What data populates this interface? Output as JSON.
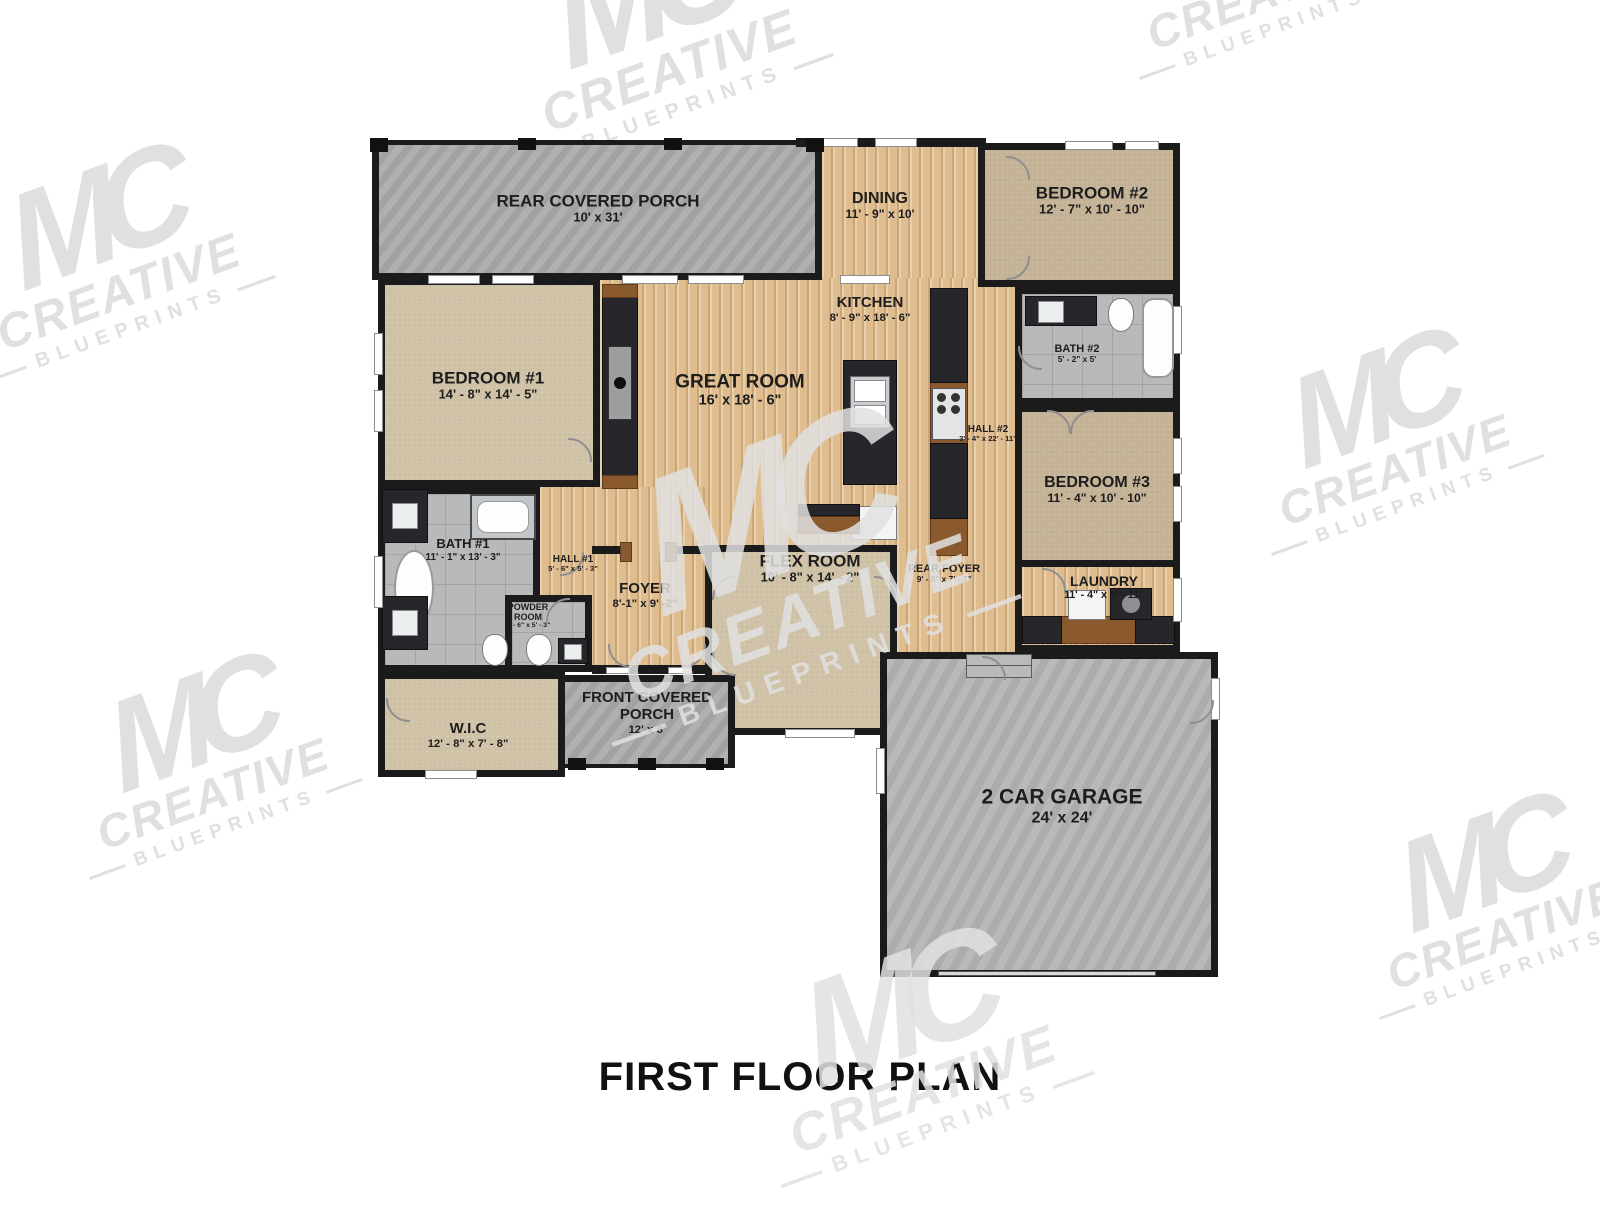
{
  "title": "FIRST FLOOR PLAN",
  "watermark": {
    "mc": "MC",
    "creative": "CREATIVE",
    "blueprints": "BLUEPRINTS"
  },
  "colors": {
    "wall": "#1b1b1b",
    "wood_floor": "#dfbd8f",
    "carpet": "#cdbfa4",
    "tile": "#b7b9bb",
    "concrete": "#aaacad",
    "accent_wood": "#8a5a2e",
    "watermark_gray": "#e0e0e0"
  },
  "rooms": {
    "rear_porch": {
      "name": "REAR COVERED PORCH",
      "dims": "10' x 31'"
    },
    "dining": {
      "name": "DINING",
      "dims": "11' - 9\" x 10'"
    },
    "bedroom2": {
      "name": "BEDROOM #2",
      "dims": "12' - 7\" x 10' - 10\""
    },
    "bedroom1": {
      "name": "BEDROOM #1",
      "dims": "14' - 8\" x 14' - 5\""
    },
    "great_room": {
      "name": "GREAT ROOM",
      "dims": "16' x 18' - 6\""
    },
    "kitchen": {
      "name": "KITCHEN",
      "dims": "8' - 9\" x 18' - 6\""
    },
    "bath2": {
      "name": "BATH #2",
      "dims": "5' - 2\" x 5'"
    },
    "hall2": {
      "name": "HALL #2",
      "dims": "3' - 4\" x 22' - 11\""
    },
    "bedroom3": {
      "name": "BEDROOM #3",
      "dims": "11' - 4\" x 10' - 10\""
    },
    "bath1": {
      "name": "BATH #1",
      "dims": "11' - 1\" x 13' - 3\""
    },
    "hall1": {
      "name": "HALL #1",
      "dims": "5' - 6\" x 5' - 3\""
    },
    "powder": {
      "name": "POWDER ROOM",
      "dims": "5' - 6\" x 5' - 3\""
    },
    "foyer": {
      "name": "FOYER",
      "dims": "8'-1\" x 9' -2\""
    },
    "flex": {
      "name": "FLEX ROOM",
      "dims": "10' - 8\" x 14' - 2\""
    },
    "rear_foyer": {
      "name": "REAR FOYER",
      "dims": "9' - 8\" x 7' - 7\""
    },
    "laundry": {
      "name": "LAUNDRY",
      "dims": "11' - 4\" x 5' - 11\""
    },
    "wic": {
      "name": "W.I.C",
      "dims": "12' - 8\" x 7' - 8\""
    },
    "front_porch": {
      "name": "FRONT COVERED PORCH",
      "dims": "12' x 8'"
    },
    "garage": {
      "name": "2 CAR GARAGE",
      "dims": "24' x 24'"
    }
  }
}
